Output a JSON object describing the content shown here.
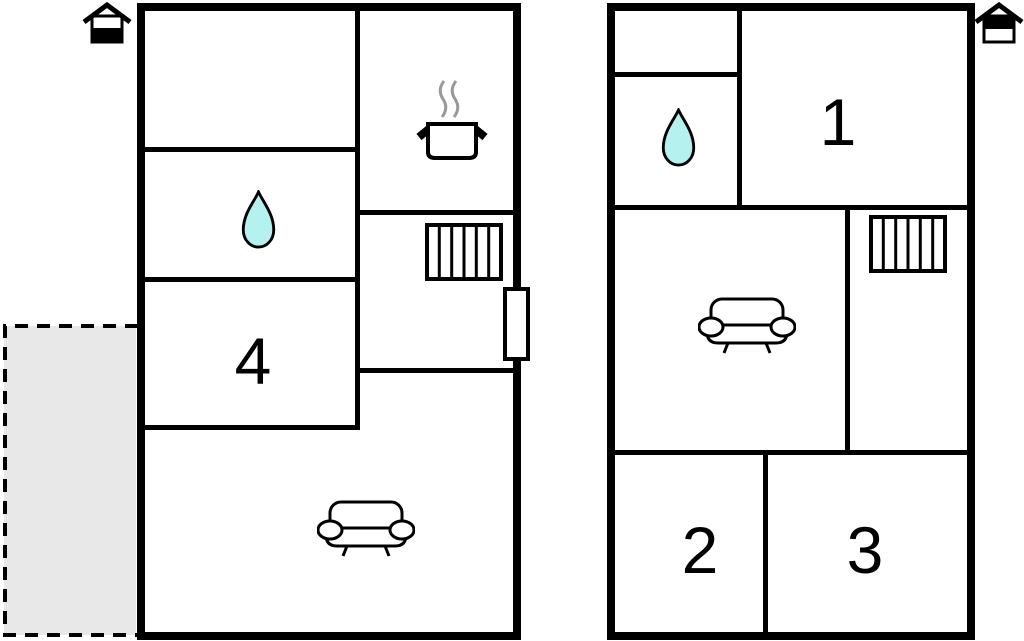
{
  "colors": {
    "wall": "#000000",
    "background": "#ffffff",
    "water": "#b5f1ef",
    "terrace_fill": "#e8e8e8",
    "steam": "#999999",
    "pot_fill": "#ffffff"
  },
  "plans": {
    "left": {
      "labels": {
        "room4": "4"
      },
      "icons": [
        "house-floor-indicator-ground",
        "cooking-pot",
        "steam",
        "water-drop",
        "stairs",
        "door",
        "sofa",
        "terrace"
      ]
    },
    "right": {
      "labels": {
        "room1": "1",
        "room2": "2",
        "room3": "3"
      },
      "icons": [
        "house-floor-indicator-upper",
        "water-drop",
        "stairs",
        "sofa"
      ]
    }
  }
}
